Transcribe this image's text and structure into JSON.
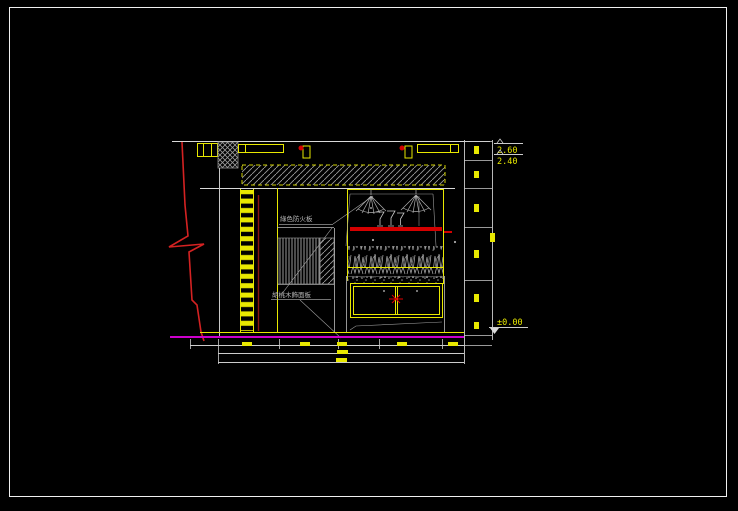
{
  "app": {
    "type": "cad-drawing-canvas",
    "background": "#000000",
    "frame_color": "#f0f0f0"
  },
  "drawing": {
    "labels": {
      "material_top": "綠色防火板",
      "material_bottom": "胡桃木飾面板"
    },
    "elevations": {
      "upper": "2.60",
      "lower": "2.40",
      "floor": "±0.00"
    },
    "colors": {
      "cad_yellow": "#e8e800",
      "line_white": "#d9d9d9",
      "hatch_gray": "#9a9a9a",
      "bright_red": "#d40000",
      "dark_red": "#8a1515",
      "magenta": "#cc00cc"
    }
  }
}
